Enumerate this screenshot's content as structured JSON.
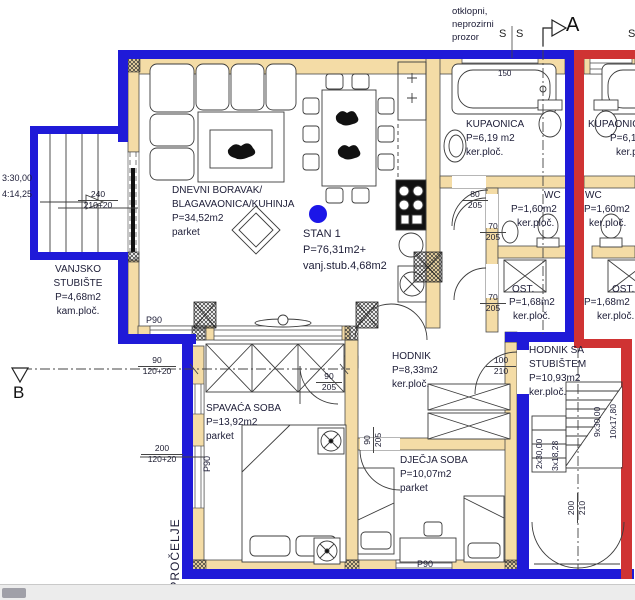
{
  "title": "floor-plan STAN 1",
  "labels": {
    "window_note": {
      "l1": "otklopni,",
      "l2": "neprozirni",
      "l3": "prozor"
    },
    "section_a": "A",
    "section_b": "B",
    "s1": "S",
    "s2": "S",
    "s3": "S",
    "stan": {
      "l1": "STAN 1",
      "l2": "P=76,31m2+",
      "l3": "vanj.stub.4,68m2"
    },
    "facade": "OPROČELJE",
    "tub_len": "150"
  },
  "rooms": {
    "living": {
      "l1": "DNEVNI BORAVAK/",
      "l2": "BLAGAVAONICA/KUHINJA",
      "area": "P=34,52m2",
      "floor": "parket"
    },
    "ext_stair": {
      "l1": "VANJSKO",
      "l2": "STUBIŠTE",
      "area": "P=4,68m2",
      "floor": "kam.ploč."
    },
    "bath": {
      "name": "KUPAONICA",
      "area": "P=6,19 m2",
      "floor": "ker.ploč."
    },
    "wc": {
      "name": "WC",
      "area": "P=1,60m2",
      "floor": "ker.ploč."
    },
    "ost": {
      "name": "OST.",
      "area": "P=1,68m2",
      "floor": "ker.ploč."
    },
    "hall": {
      "name": "HODNIK",
      "area": "P=8,33m2",
      "floor": "ker.ploč."
    },
    "hall_stair": {
      "l1": "HODNIK SA",
      "l2": "STUBIŠTEM",
      "area": "P=10,93m2",
      "floor": "ker.ploč."
    },
    "bedroom": {
      "name": "SPAVAĆA SOBA",
      "area": "P=13,92m2",
      "floor": "parket"
    },
    "kids": {
      "name": "DJEČJA SOBA",
      "area": "P=10,07m2",
      "floor": "parket"
    },
    "bath2": {
      "name": "KUPAONICA",
      "area": "P=6,19 m2",
      "floor": "ker.ploč."
    },
    "wc2": {
      "name": "WC",
      "area": "P=1,60m2",
      "floor": "ker.ploč."
    },
    "ost2": {
      "name": "OST.",
      "area": "P=1,68m2",
      "floor": "ker.ploč."
    }
  },
  "dims": {
    "d1": {
      "a": "240",
      "b": "210+20"
    },
    "d2": {
      "a": "90",
      "b": "120+20"
    },
    "d3": {
      "a": "200",
      "b": "120+20"
    },
    "d4": {
      "a": "80",
      "b": "205"
    },
    "d5": {
      "a": "70",
      "b": "205"
    },
    "d6": {
      "a": "70",
      "b": "205"
    },
    "d7": {
      "a": "100",
      "b": "210"
    },
    "d8": {
      "a": "90",
      "b": "205"
    },
    "d9": {
      "a": "90",
      "b": "205"
    },
    "d10": {
      "a": "200",
      "b": "210"
    },
    "p90a": "P90",
    "p90b": "P90",
    "p90c": "P90",
    "stair_l1": "3:30,00",
    "stair_l2": "4:14,25",
    "st1": "2x30,00",
    "st2": "3x18,28",
    "st3": "9x30,00",
    "st4": "10x17,80"
  },
  "colors": {
    "unit_boundary_blue": "#1f1ad8",
    "neighbor_boundary_red": "#cf3333",
    "wall_fill_tan": "#f4dca6",
    "marker_dot_blue": "#1b16e8"
  }
}
